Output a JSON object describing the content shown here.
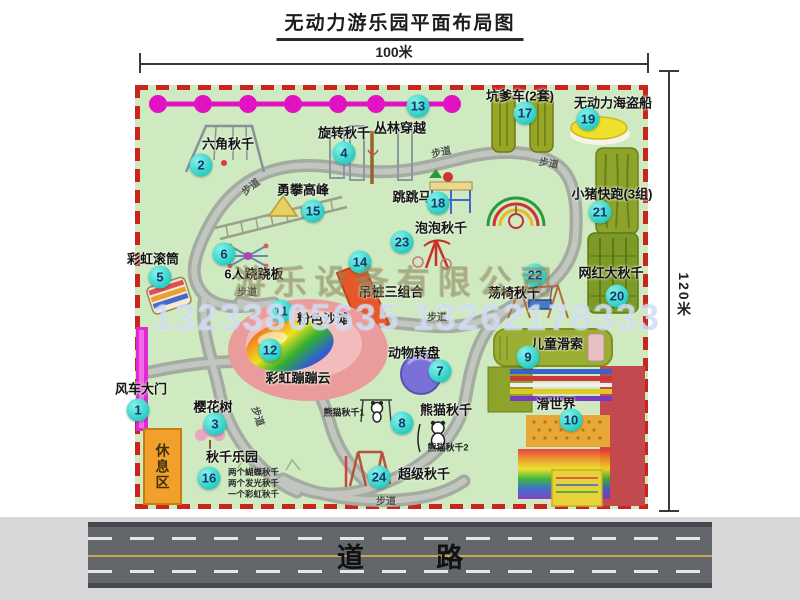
{
  "title": "无动力游乐园平面布局图",
  "dimensions": {
    "width": "100米",
    "height": "120米"
  },
  "road": {
    "label": "道 路"
  },
  "rest_area": {
    "label": "休息区"
  },
  "walkway": {
    "label": "步道",
    "positions": [
      {
        "x": 250,
        "y": 186,
        "r": -38
      },
      {
        "x": 441,
        "y": 151,
        "r": -12
      },
      {
        "x": 549,
        "y": 162,
        "r": 10
      },
      {
        "x": 247,
        "y": 291,
        "r": 0
      },
      {
        "x": 437,
        "y": 316,
        "r": 0
      },
      {
        "x": 259,
        "y": 416,
        "r": 72
      },
      {
        "x": 386,
        "y": 500,
        "r": 0
      }
    ]
  },
  "watermark": {
    "phone": "13233805635 13262178333",
    "company": "游乐设备有限公司"
  },
  "items": [
    {
      "num": 1,
      "name": "风车大门",
      "cx": 138,
      "cy": 410,
      "lx": 141,
      "ly": 388
    },
    {
      "num": 2,
      "name": "六角秋千",
      "cx": 201,
      "cy": 165,
      "lx": 228,
      "ly": 143
    },
    {
      "num": 3,
      "name": "樱花树",
      "cx": 215,
      "cy": 424,
      "lx": 213,
      "ly": 406
    },
    {
      "num": 4,
      "name": "旋转秋千",
      "cx": 344,
      "cy": 153,
      "lx": 344,
      "ly": 132
    },
    {
      "num": 5,
      "name": "彩虹滚筒",
      "cx": 160,
      "cy": 277,
      "lx": 153,
      "ly": 258
    },
    {
      "num": 6,
      "name": "6人跷跷板",
      "cx": 224,
      "cy": 254,
      "lx": 254,
      "ly": 273
    },
    {
      "num": 7,
      "name": "动物转盘",
      "cx": 440,
      "cy": 371,
      "lx": 414,
      "ly": 352
    },
    {
      "num": 8,
      "name": "熊猫秋千",
      "cx": 402,
      "cy": 423,
      "lx": 446,
      "ly": 409
    },
    {
      "num": 9,
      "name": "儿童滑索",
      "cx": 528,
      "cy": 357,
      "lx": 557,
      "ly": 343
    },
    {
      "num": 10,
      "name": "滑世界",
      "cx": 571,
      "cy": 420,
      "lx": 556,
      "ly": 403
    },
    {
      "num": 11,
      "name": "粉色沙滩",
      "cx": 281,
      "cy": 311,
      "lx": 323,
      "ly": 318
    },
    {
      "num": 12,
      "name": "彩虹蹦蹦云",
      "cx": 270,
      "cy": 350,
      "lx": 298,
      "ly": 377
    },
    {
      "num": 13,
      "name": "丛林穿越",
      "cx": 418,
      "cy": 106,
      "lx": 400,
      "ly": 127
    },
    {
      "num": 14,
      "name": "吊桩三组合",
      "cx": 360,
      "cy": 262,
      "lx": 391,
      "ly": 291
    },
    {
      "num": 15,
      "name": "勇攀高峰",
      "cx": 313,
      "cy": 211,
      "lx": 303,
      "ly": 189
    },
    {
      "num": 16,
      "name": "秋千乐园",
      "cx": 209,
      "cy": 478,
      "lx": 232,
      "ly": 456,
      "notes": [
        "两个蝴蝶秋千",
        "两个发光秋千",
        "一个彩虹秋千"
      ],
      "nx": 228,
      "ny": 472
    },
    {
      "num": 17,
      "name": "坑爹车(2套)",
      "cx": 525,
      "cy": 113,
      "lx": 520,
      "ly": 95
    },
    {
      "num": 18,
      "name": "跳跳马",
      "cx": 438,
      "cy": 203,
      "lx": 412,
      "ly": 196
    },
    {
      "num": 19,
      "name": "无动力海盗船",
      "cx": 588,
      "cy": 119,
      "lx": 613,
      "ly": 102
    },
    {
      "num": 20,
      "name": "网红大秋千",
      "cx": 617,
      "cy": 296,
      "lx": 611,
      "ly": 272
    },
    {
      "num": 21,
      "name": "小猪快跑(3组)",
      "cx": 600,
      "cy": 212,
      "lx": 612,
      "ly": 193
    },
    {
      "num": 22,
      "name": "荡椅秋千",
      "cx": 535,
      "cy": 275,
      "lx": 514,
      "ly": 292
    },
    {
      "num": 23,
      "name": "泡泡秋千",
      "cx": 402,
      "cy": 242,
      "lx": 441,
      "ly": 227
    },
    {
      "num": 24,
      "name": "超级秋千",
      "cx": 379,
      "cy": 477,
      "lx": 424,
      "ly": 473
    }
  ],
  "extra_labels": [
    {
      "text": "熊猫秋千1",
      "x": 344,
      "y": 412
    },
    {
      "text": "熊猫秋千2",
      "x": 448,
      "y": 447
    }
  ],
  "colors": {
    "map_green": "#cfe9c0",
    "border_red": "#c9251d",
    "marker_teal": "#2fd2c8",
    "marker_text_navy": "#14386e",
    "zipline_magenta": "#e212c2",
    "gate_magenta": "#de2ad2",
    "rest_orange": "#f2a02c",
    "walkway_gray": "#a5aaa3",
    "road_gray": "#63666b",
    "lane_yellow": "#c9a94e",
    "beach_pink": "#ea9c9c",
    "carousel_purple": "#7a70d8",
    "pirate_yellow": "#eee02c",
    "equip_olive": "#8ea32c",
    "slide_crimson": "#c24a4e"
  }
}
